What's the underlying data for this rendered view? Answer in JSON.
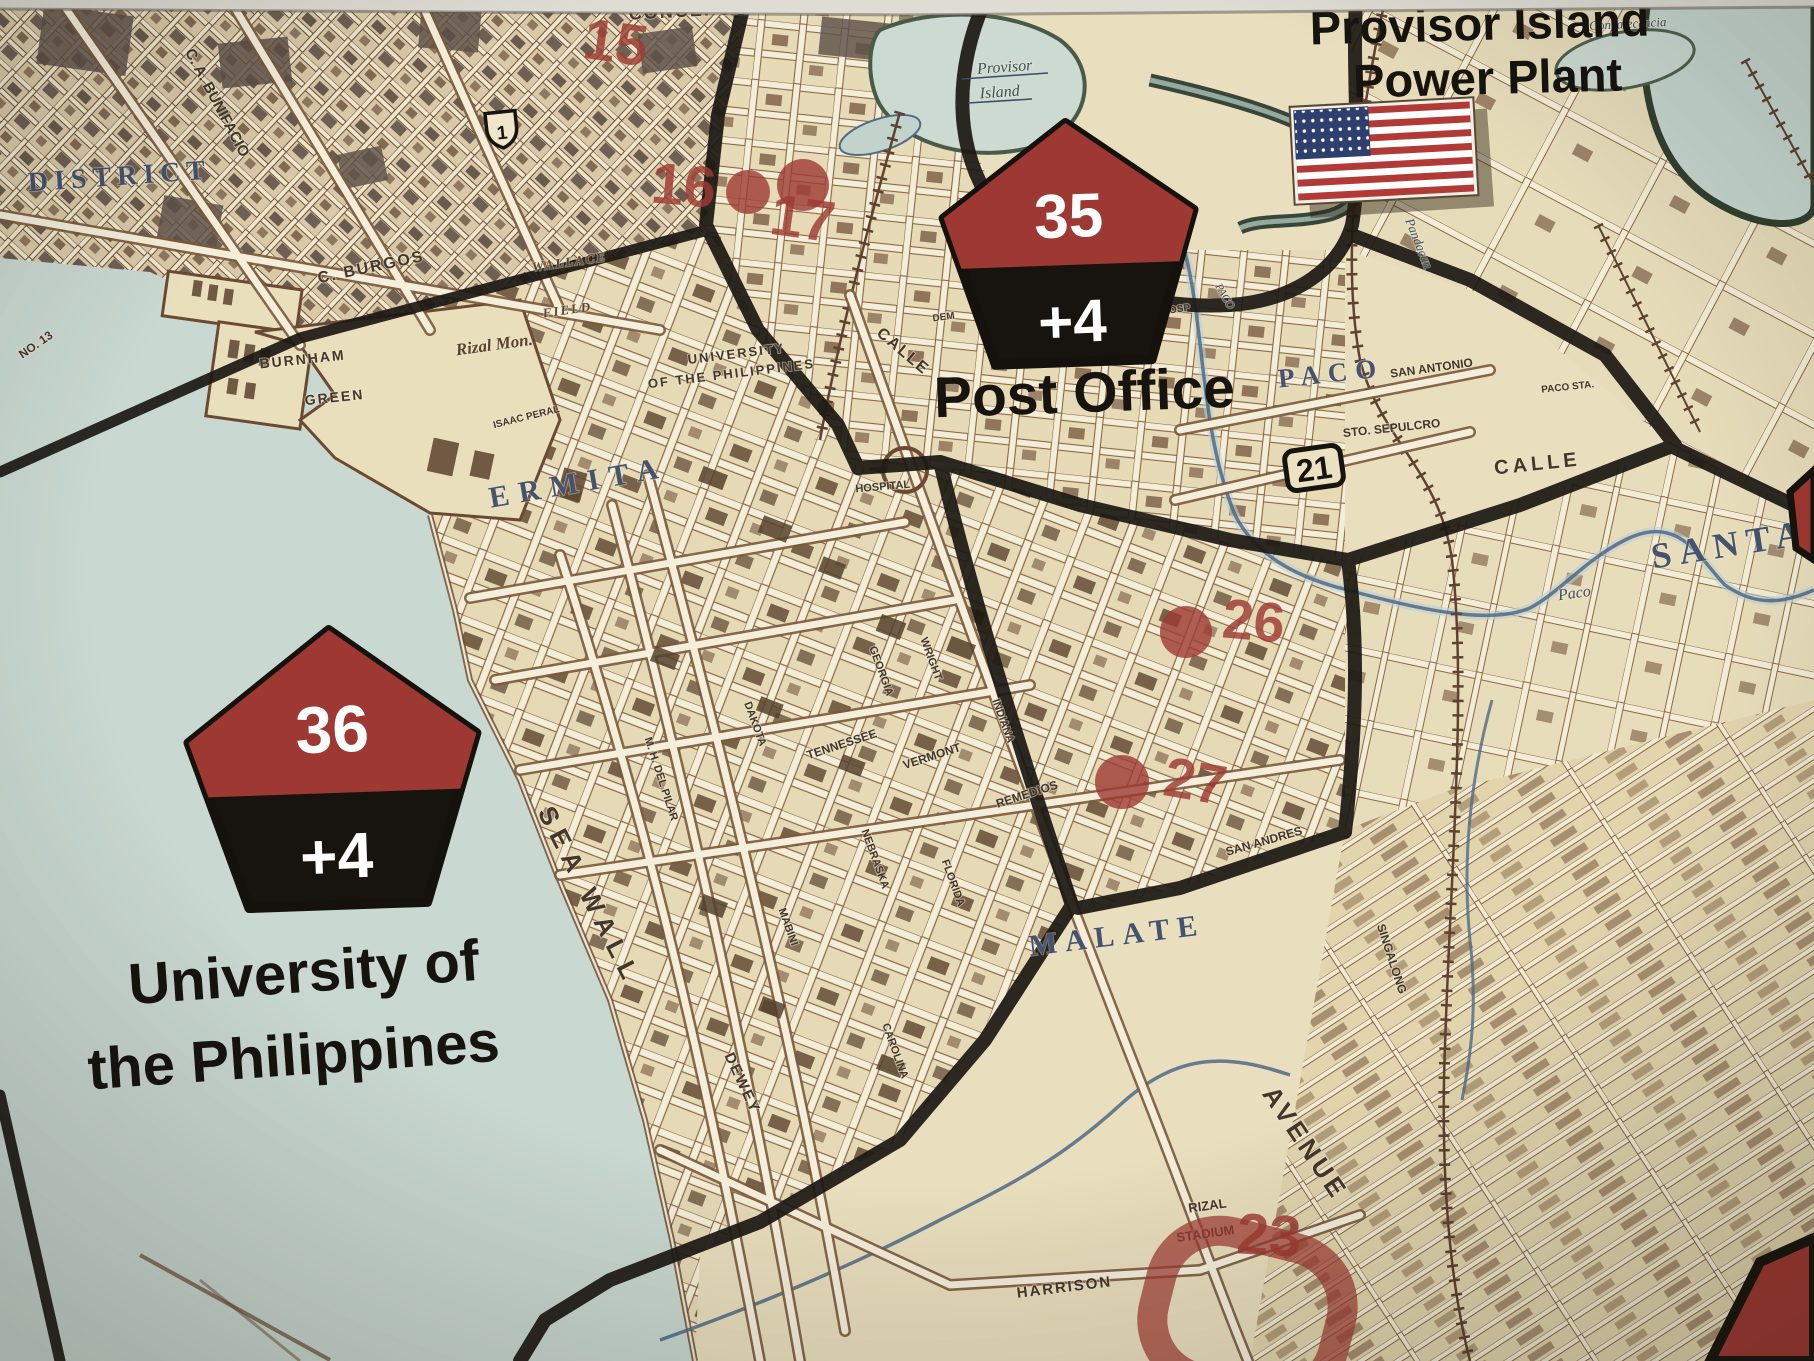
{
  "titles": {
    "power_plant_line1": "Provisor Island",
    "power_plant_line2": "Power Plant"
  },
  "counters": {
    "post_office": {
      "number": "35",
      "modifier": "+4",
      "name": "Post Office"
    },
    "university": {
      "number": "36",
      "modifier": "+4",
      "name_line1": "University of",
      "name_line2": "the Philippines"
    }
  },
  "markers": {
    "highway_shield": "1",
    "route_box": "21"
  },
  "red_marks": {
    "m15": "15",
    "m16": "16",
    "m17": "17",
    "m23": "23",
    "m26": "26",
    "m27": "27"
  },
  "region_labels": {
    "district": "DISTRICT",
    "ermita": "ERMITA",
    "malate": "MALATE",
    "paco": "PACO",
    "santa_ana": "SANTA",
    "provisor_line1": "Provisor",
    "provisor_line2": "Island",
    "convalecencia": "Convalecencia"
  },
  "street_labels": {
    "concepcion": "CONCEPCION",
    "bunifacio": "C. A. BUNIFACIO",
    "burgos": "C. BURGOS",
    "wallace": "WALLACE",
    "field": "FIELD",
    "burnham": "BURNHAM",
    "green": "GREEN",
    "rizal_mon": "Rizal Mon.",
    "university_small_1": "UNIVERSITY",
    "university_small_2": "OF THE PHILIPPINES",
    "isaac_peral": "ISAAC PERAL",
    "hospital": "HOSPITAL",
    "calle_ermita": "CALLE",
    "calle_paco": "CALLE",
    "dem": "DEM",
    "osp": "OSP",
    "san_antonio": "SAN ANTONIO",
    "sto_sepulcro": "STO. SEPULCRO",
    "paco_sta": "PACO STA.",
    "georgia": "GEORGIA",
    "wright": "WRIGHT",
    "dakota": "DAKOTA",
    "tennessee": "TENNESSEE",
    "vermont": "VERMONT",
    "indiana": "INDIANA",
    "remedios": "REMEDIOS",
    "nebraska": "NEBRASKA",
    "florida": "FLORIDA",
    "del_pilar": "M. H. DEL PILAR",
    "mabini": "MABINI",
    "dewey": "DEWEY",
    "carolina": "CAROLINA",
    "san_andres": "SAN ANDRES",
    "avenue": "AVENUE",
    "harrison": "HARRISON",
    "rizal_stadium_1": "RIZAL",
    "rizal_stadium_2": "STADIUM",
    "singalong": "SINGALONG",
    "sea_wall": "SEA WALL",
    "pier_no": "NO. 13"
  },
  "water_labels": {
    "estero": "Estero",
    "de": "de",
    "pandacan": "Pandacan",
    "paco_creek": "PACO",
    "paco_river": "Paco"
  },
  "colors": {
    "land": "#e9debd",
    "water": "#c9d8d0",
    "boundary": "#1c1914",
    "street_brown": "#7b5a3e",
    "building": "#5c432e",
    "red_mark": "#9e3a33",
    "blue_label": "#45536e",
    "black_text": "#17130e",
    "flag_red": "#b23a36",
    "flag_blue": "#2f3f6d"
  }
}
